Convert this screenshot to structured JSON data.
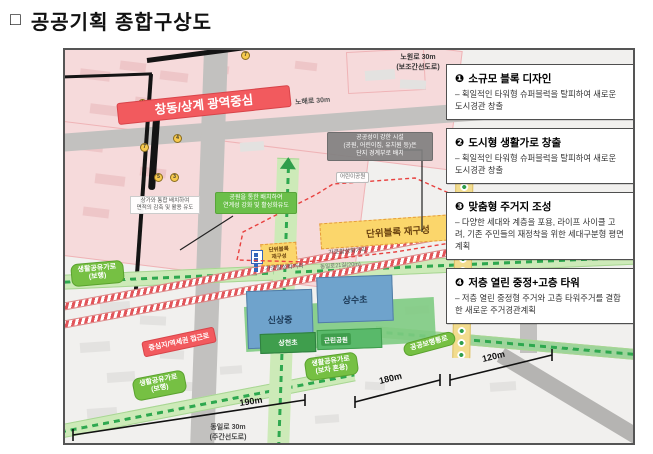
{
  "title": {
    "marker": "□",
    "text": "공공기획 종합구상도"
  },
  "legend": {
    "items": [
      {
        "num": "❶",
        "title": "소규모 블록 디자인",
        "body": "– 획일적인 타워형 슈퍼블럭을 탈피하여 새로운 도시경관 창출"
      },
      {
        "num": "❷",
        "title": "도시형 생활가로 창출",
        "body": "– 획일적인 타워형 슈퍼블럭을 탈피하여 새로운 도시경관 창출"
      },
      {
        "num": "❸",
        "title": "맞춤형 주거지 조성",
        "body": "– 다양한 세대와 계층을 포용, 라이프 사이클 고려, 기존 주민들의 재정착을 위한 세대구분형 평면 계획"
      },
      {
        "num": "❹",
        "title": "저층 열린 중정+고층 타워",
        "body": "– 저층 열린 중정형 주거와 고층 타워주거를 결합한 새로운 주거경관계획"
      }
    ]
  },
  "map": {
    "region_center_label": "창동/상계 광역중심",
    "roads": {
      "nohae": "노해로 30m",
      "nowon": "노원로 30m\n(보조간선도로)",
      "dongil": "동일로 30m\n(주간선도로)",
      "dongil21": "동일로21길(20m)"
    },
    "corridors": {
      "living_walk": "생활공유가로\n(보행)",
      "living_mixed": "생활공유가로\n(보차 혼용)",
      "public_walkway": "공공보행통로",
      "access": "중심지/역세권 접근로",
      "street_activation": "가로활성화거리"
    },
    "blocks": {
      "unit_large": "단위블록 재구성",
      "unit_small": "단위블록\n재구성"
    },
    "places": {
      "shinsang": "신상중",
      "sangsu": "상수초",
      "sangcheon": "상천초",
      "park": "근린공원",
      "child_park": "어린이공원"
    },
    "callouts": {
      "public_facility": "공공성이 강한 시설\n(공원, 어린이집, 유치원 등)은\n단지 경계부로 배치",
      "park_link": "공원을 통한 배치하여\n연계성 강화 및 활성화유도",
      "station_note": "상가와 통합 배치하여\n면적의 감축 및 활용 유도"
    },
    "dimensions": {
      "d190": "190m",
      "d180": "180m",
      "d120": "120m"
    },
    "exits": [
      "1",
      "2",
      "4",
      "7",
      "5",
      "3",
      "7"
    ]
  }
}
